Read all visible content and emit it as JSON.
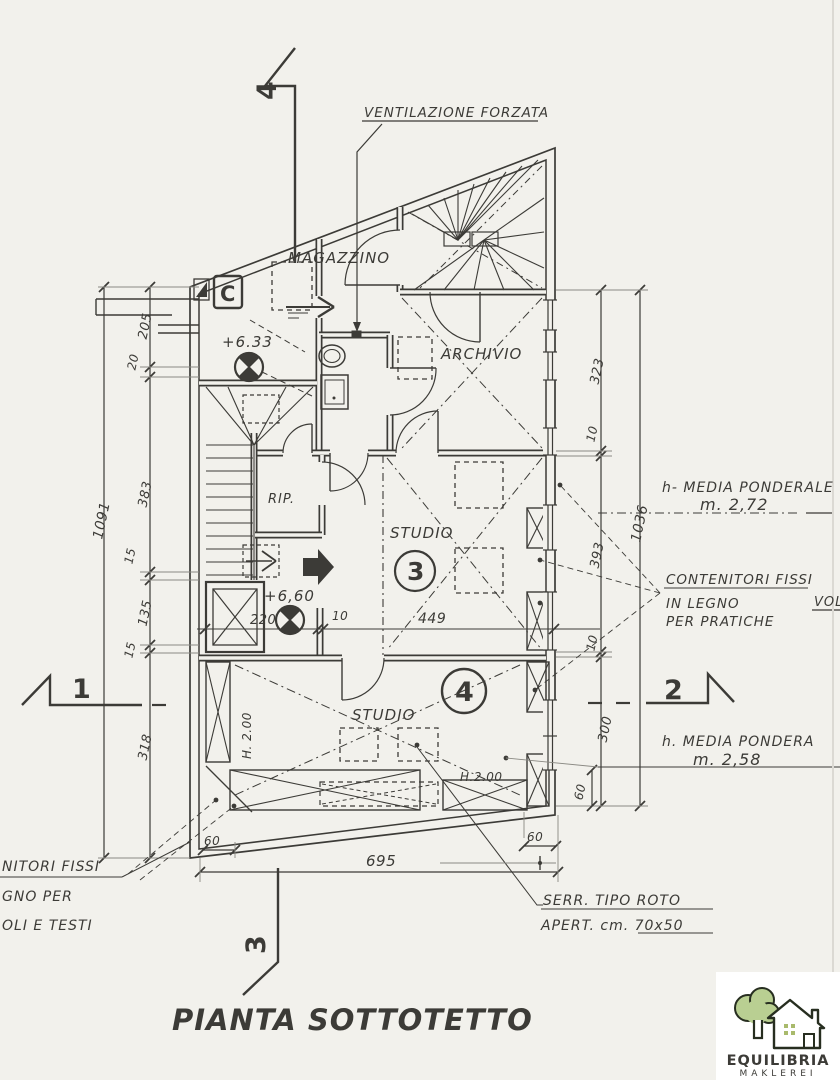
{
  "colors": {
    "paper": "#f2f1ec",
    "ink": "#3c3b37",
    "ink_light": "#8a8983",
    "logo_green": "#b9cf92",
    "logo_dark": "#272e20",
    "logo_olive": "#a9ba6c",
    "logo_bg": "#ffffff"
  },
  "title": "PIANTA SOTTOTETTO",
  "section_markers": {
    "top": "4",
    "left": "1",
    "right": "2",
    "bottom": "3"
  },
  "rooms": {
    "magazzino": "MAGAZZINO",
    "archivio": "ARCHIVIO",
    "rip": "RIP.",
    "studio_upper": "STUDIO",
    "studio_upper_num": "3",
    "studio_lower": "STUDIO",
    "studio_lower_num": "4",
    "reference": "C"
  },
  "levels": {
    "upper": "+6.33",
    "lower": "+6,60"
  },
  "heights": {
    "studio_lower_left": "H. 2.00",
    "studio_lower_right": "H.2.00"
  },
  "annotations": {
    "ventilation": "VENTILAZIONE FORZATA",
    "avg_height_upper_label": "h- MEDIA PONDERALE",
    "avg_height_upper_value": "m. 2,72",
    "containers_line1": "CONTENITORI FISSI",
    "containers_line2": "IN LEGNO",
    "containers_line3": "PER PRATICHE",
    "volume_clipped": "VOL",
    "avg_height_lower_label": "h. MEDIA PONDERA",
    "avg_height_lower_value": "m. 2,58",
    "skylight_line1": "SERR. TIPO ROTO",
    "skylight_line2": "APERT. cm. 70x50",
    "left_note_line1": "NITORI FISSI",
    "left_note_line2": "GNO PER",
    "left_note_line3": "OLI E TESTI"
  },
  "dimensions": {
    "left_total": "1091",
    "left_chain": [
      "205",
      "20",
      "383",
      "15",
      "135",
      "15",
      "318"
    ],
    "right_total": "1036",
    "right_chain": [
      "323",
      "10",
      "393",
      "10",
      "300"
    ],
    "right_offset": "60",
    "bottom_total": "695",
    "bottom_offset_left": "60",
    "bottom_offset_right": "60",
    "interior_220": "220",
    "interior_10": "10",
    "interior_449": "449"
  },
  "logo": {
    "name": "EQUILIBRIA",
    "subtitle": "MAKLEREI"
  }
}
